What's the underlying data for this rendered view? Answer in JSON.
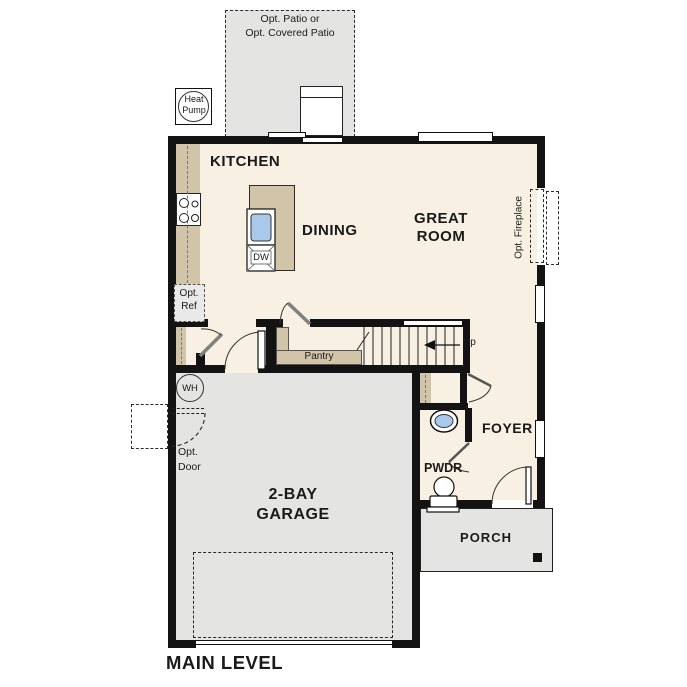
{
  "plan_title": "MAIN LEVEL",
  "rooms": {
    "kitchen": "KITCHEN",
    "dining": "DINING",
    "great_room_line1": "GREAT",
    "great_room_line2": "ROOM",
    "garage_line1": "2-BAY",
    "garage_line2": "GARAGE",
    "foyer": "FOYER",
    "powder": "PWDR",
    "porch": "PORCH",
    "pantry": "Pantry"
  },
  "annotations": {
    "patio_line1": "Opt. Patio or",
    "patio_line2": "Opt. Covered Patio",
    "heat_pump_line1": "Heat",
    "heat_pump_line2": "Pump",
    "opt_ref_line1": "Opt.",
    "opt_ref_line2": "Ref",
    "opt_door_line1": "Opt.",
    "opt_door_line2": "Door",
    "opt_fireplace": "Opt. Fireplace",
    "stairs_direction": "Up",
    "water_heater": "WH",
    "dishwasher": "DW"
  },
  "colors": {
    "floor": "#f8f0e2",
    "counter": "#d2c4a8",
    "concrete": "#e4e4e2",
    "wall": "#131313",
    "sink": "#a9c9ea",
    "optref": "#e9e9e9"
  }
}
